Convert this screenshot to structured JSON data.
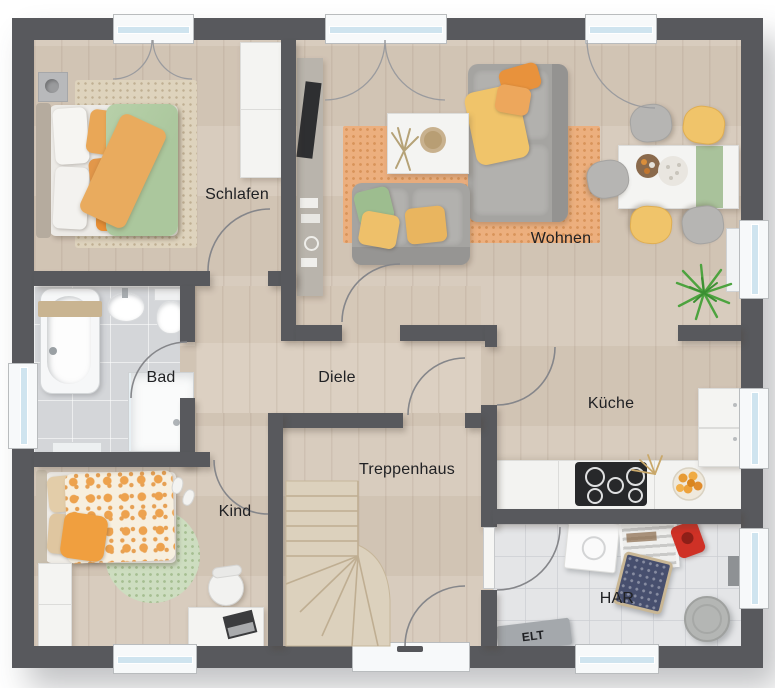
{
  "plan": {
    "labels": {
      "schlafen": {
        "text": "Schlafen"
      },
      "wohnen": {
        "text": "Wohnen"
      },
      "bad": {
        "text": "Bad"
      },
      "diele": {
        "text": "Diele"
      },
      "kueche": {
        "text": "Küche"
      },
      "kind": {
        "text": "Kind"
      },
      "treppenhaus": {
        "text": "Treppenhaus"
      },
      "har": {
        "text": "HAR"
      },
      "elt": {
        "text": "ELT"
      }
    },
    "colors": {
      "wall": "#58595d",
      "wood_floor": "#d6c9ba",
      "hall_floor": "#dacdbe",
      "bath_tile": "#d4d6d9",
      "utility_tile": "#e4e5e7",
      "window_glass": "#cfe4ef",
      "label_text": "#202124",
      "rug_orange": "#ecaf7e",
      "rug_green": "#cdddc0",
      "rug_beige": "#ded3bd",
      "sofa_gray": "#a5a4a1",
      "accent_orange": "#eda24e",
      "accent_yellow": "#f0c46a",
      "accent_green": "#abc79d",
      "plant_green": "#4da33f",
      "stairs_wood": "#dcd1bd"
    }
  }
}
